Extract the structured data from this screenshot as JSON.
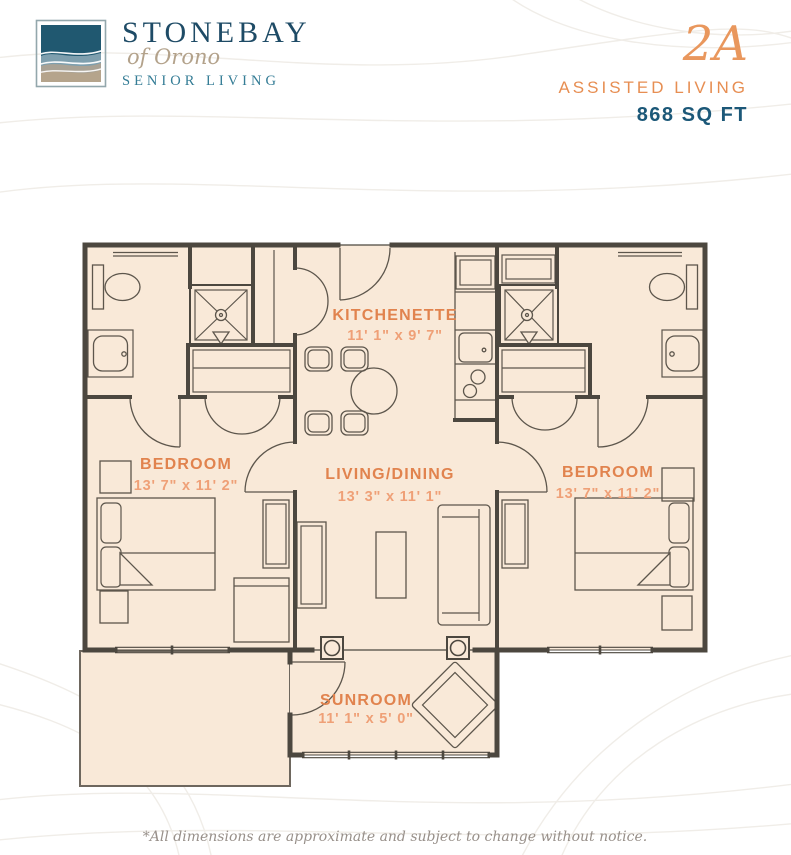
{
  "brand": {
    "name": "STONEBAY",
    "tagline": "of Orono",
    "subtitle": "SENIOR LIVING"
  },
  "unit": {
    "code": "2A",
    "type": "ASSISTED LIVING",
    "area": "868 SQ FT"
  },
  "floor_plan": {
    "rooms": {
      "kitchenette": {
        "name": "KITCHENETTE",
        "dims": "11' 1\" x 9' 7\""
      },
      "bedroom_left": {
        "name": "BEDROOM",
        "dims": "13' 7\" x 11' 2\""
      },
      "living_dining": {
        "name": "LIVING/DINING",
        "dims": "13' 3\" x 11' 1\""
      },
      "bedroom_right": {
        "name": "BEDROOM",
        "dims": "13' 7\" x 11' 2\""
      },
      "sunroom": {
        "name": "SUNROOM",
        "dims": "11' 1\" x 5' 0\""
      }
    }
  },
  "footer": {
    "disclaimer": "*All dimensions are approximate and subject to change without notice."
  },
  "colors": {
    "accent_orange": "#e1834e",
    "accent_orange_light": "#efa077",
    "brand_navy": "#1e4b66",
    "brand_teal": "#357d96",
    "brand_tan": "#b3a28b",
    "unit_code_orange": "#e9975d",
    "unit_type_orange": "#e78e52",
    "sqft_teal": "#1c5878",
    "floor_fill": "#f9e9d8",
    "wall": "#4c473f",
    "disclaimer_gray": "#98908a"
  }
}
